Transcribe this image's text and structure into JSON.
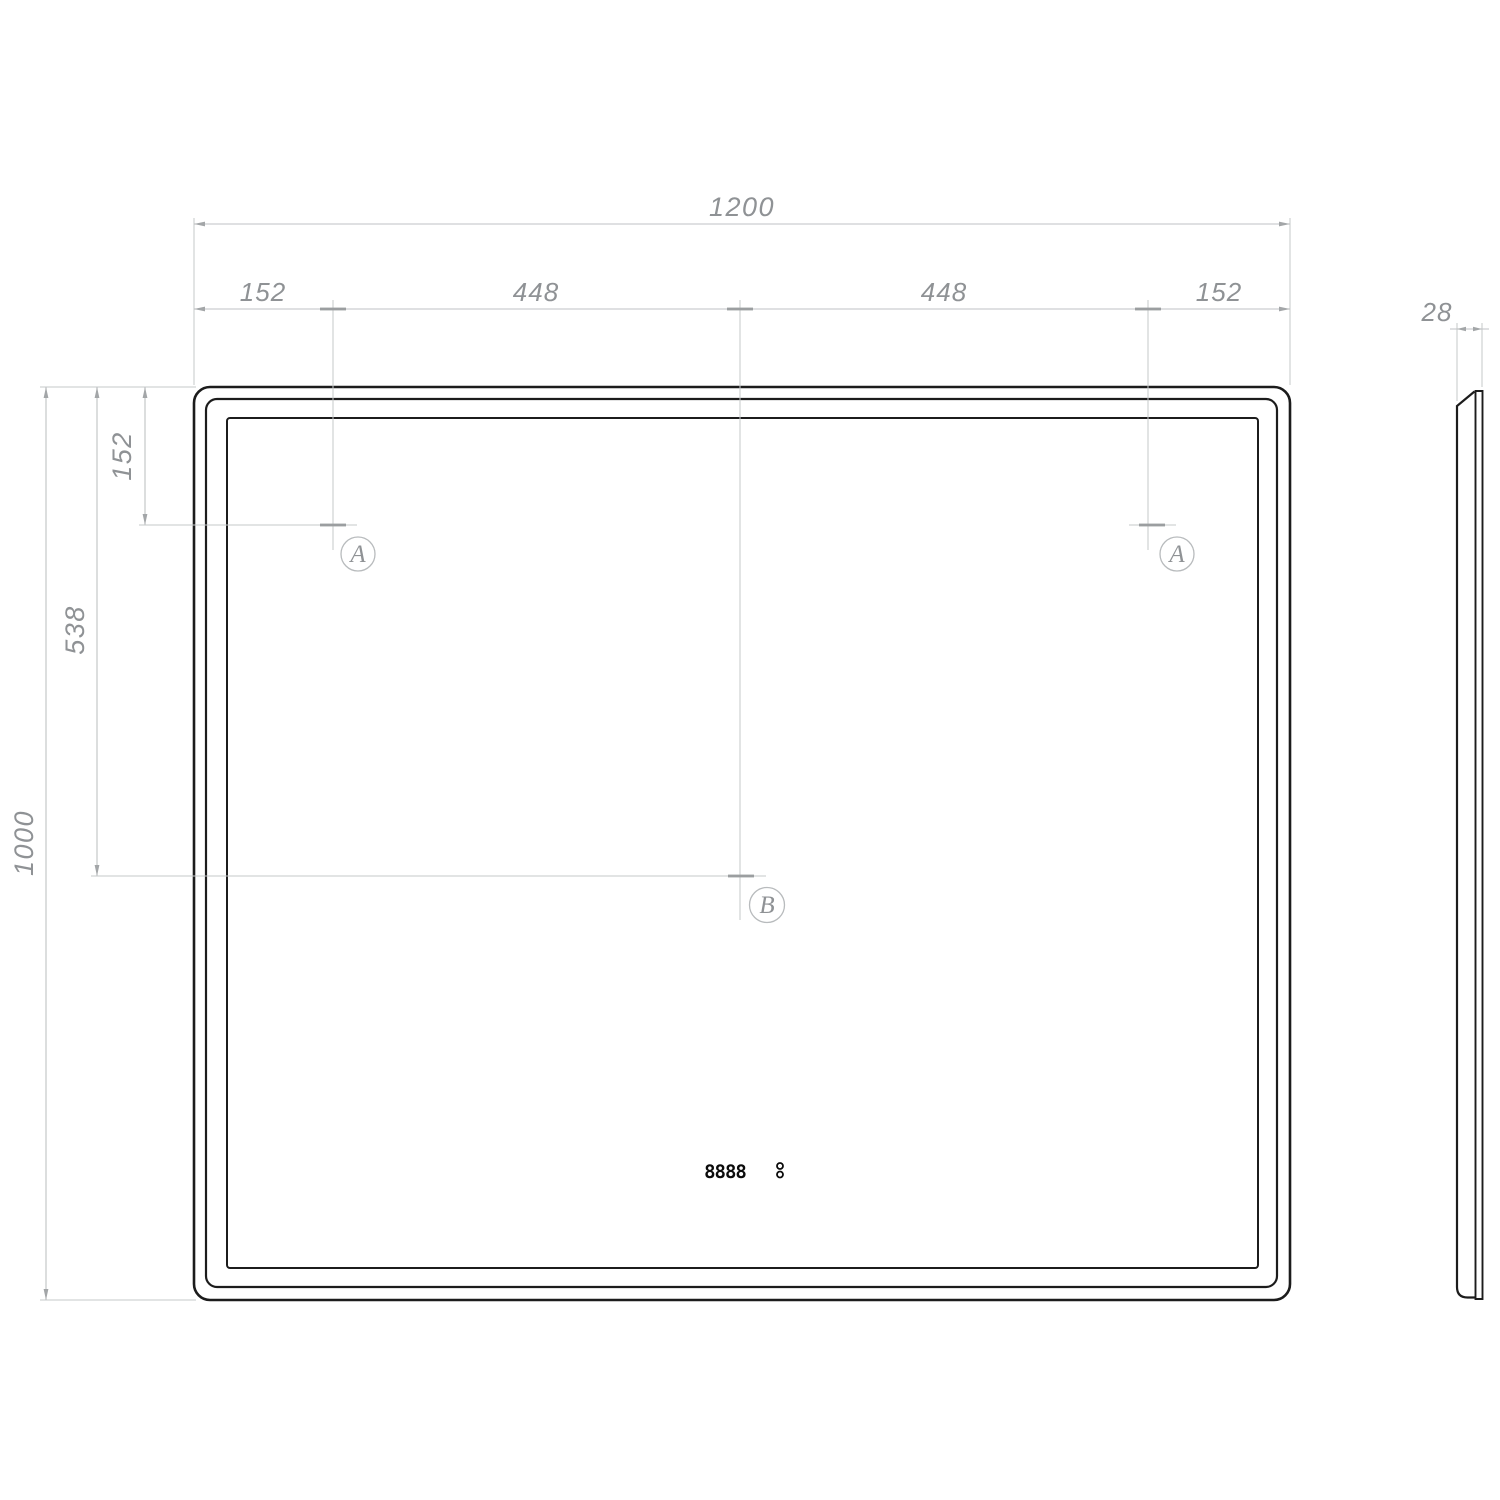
{
  "dimensions": {
    "overall_width": "1200",
    "top_segments": [
      "152",
      "448",
      "448",
      "152"
    ],
    "side_top_offset": "152",
    "side_mid": "538",
    "overall_height": "1000",
    "depth": "28"
  },
  "mount_points": {
    "a": "A",
    "b": "B"
  },
  "display": {
    "value": "8888"
  },
  "colors": {
    "outline": "#1c1c1c",
    "dim_line": "#bfc2c4",
    "dim_text": "#8f9295"
  }
}
